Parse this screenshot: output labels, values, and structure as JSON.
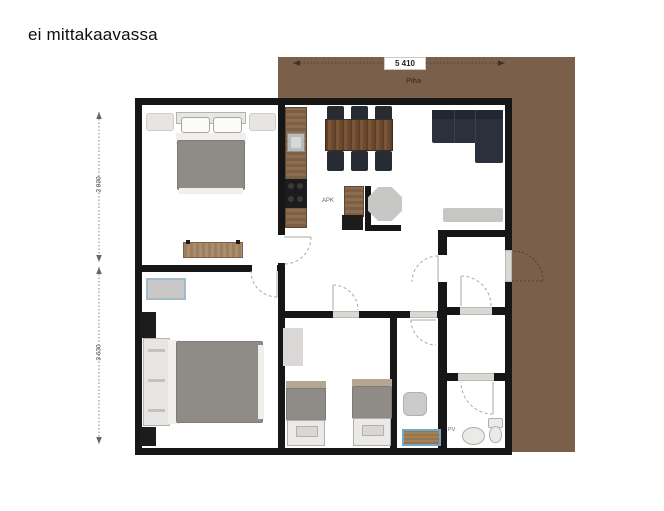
{
  "texts": {
    "not_to_scale": "ei mittakaavassa",
    "patio_label": "Piha",
    "dim_top": "5 410",
    "dim_left_upper": "2 930",
    "dim_left_lower": "3 630",
    "label_appliance": "APK",
    "label_laundry": "PV"
  },
  "palette": {
    "background": "#ffffff",
    "wall": "#161616",
    "patio": "#7a604a",
    "bed_blanket": "#8f8c88",
    "wood_table": "#6b4a30",
    "wood_counter": "#8a6a4e",
    "wood_bench": "#a5876a",
    "chair": "#272c34",
    "sofa": "#2b303c",
    "fixture_gray": "#c9c9c7",
    "mat_blue_border": "#6fa8cc",
    "dimension_line": "#555555"
  },
  "legend": {
    "drawing_type": "apartment floor plan, not to scale",
    "rooms": [
      "bedroom-1",
      "bedroom-2",
      "kitchen-dining",
      "living-room",
      "hallway",
      "kids-bedroom",
      "shower-room",
      "wc-upper",
      "wc-middle",
      "bathroom",
      "patio"
    ],
    "furniture": [
      "double-bed",
      "bench",
      "single-bed",
      "twin-bed-left",
      "twin-bed-right",
      "dining-table",
      "six-chairs",
      "corner-sofa",
      "kitchen-counter",
      "sink",
      "stove",
      "island-cabinet",
      "octagon-table",
      "living-rug",
      "desk",
      "wardrobe-blocks",
      "shower-pad",
      "bath-mat",
      "washbasin",
      "toilet"
    ]
  }
}
